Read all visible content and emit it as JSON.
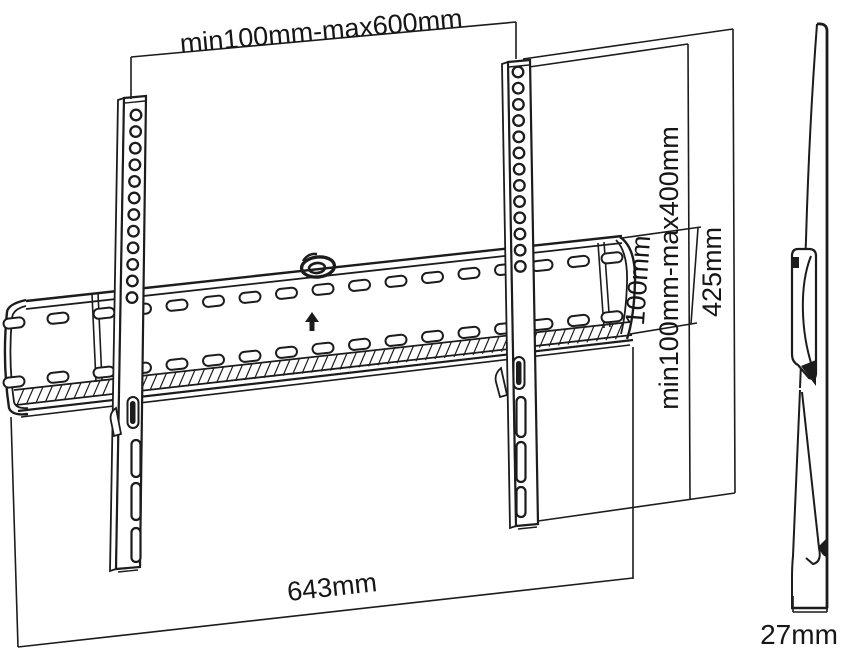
{
  "drawing": {
    "background_color": "#ffffff",
    "line_color": "#1c1c1c"
  },
  "dimensions": {
    "vesa_width": {
      "label": "min100mm-max600mm"
    },
    "vesa_height": {
      "label": "min100mm-max400mm"
    },
    "bracket_height": {
      "label": "425mm"
    },
    "plate_height": {
      "label": "100mm"
    },
    "plate_width": {
      "label": "643mm"
    },
    "profile_depth": {
      "label": "27mm"
    }
  },
  "icons": {
    "up_arrow": "▲",
    "level_indicator": "o"
  }
}
